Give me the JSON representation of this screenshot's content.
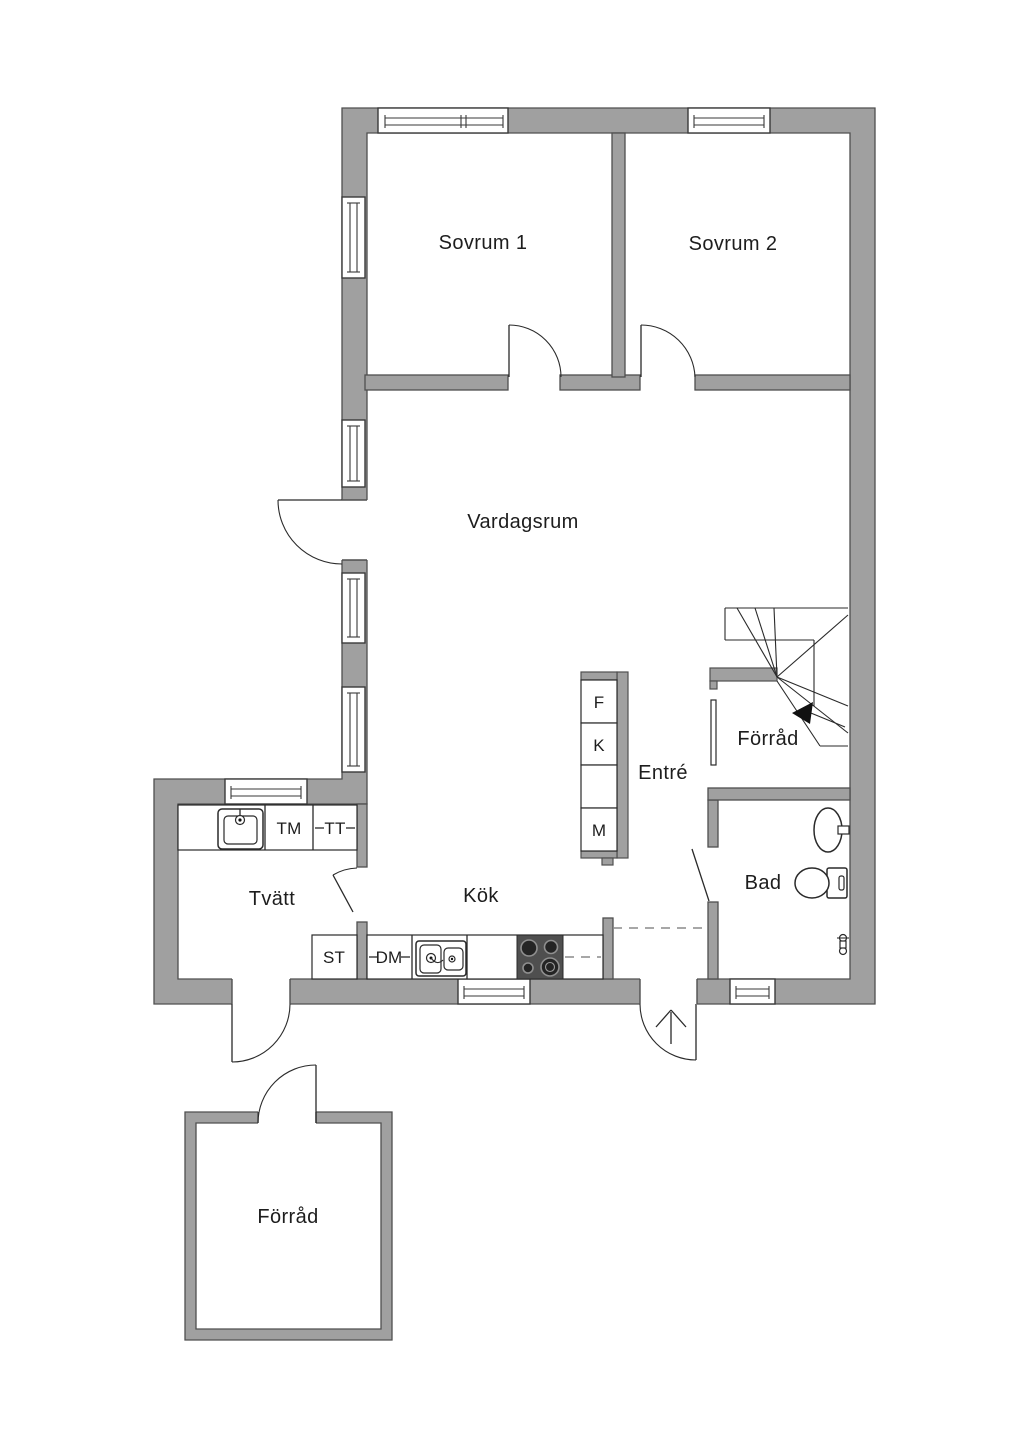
{
  "title": "Floor plan",
  "labels": {
    "sovrum1": "Sovrum 1",
    "sovrum2": "Sovrum 2",
    "vardagsrum": "Vardagsrum",
    "entre": "Entré",
    "forrad_stairs": "Förråd",
    "bad": "Bad",
    "tvatt": "Tvätt",
    "kok": "Kök",
    "forrad_outbuilding": "Förråd"
  },
  "appliances": {
    "tm": "TM",
    "tt": "TT",
    "st": "ST",
    "dm": "DM",
    "f": "F",
    "k": "K",
    "m": "M"
  },
  "colors": {
    "background": "#ffffff",
    "wall": "#a0a0a0",
    "wall_outline": "#4f4f4f",
    "line": "#2a2a2a",
    "text": "#1d1d1d",
    "stove_panel": "#4f4f4f"
  },
  "icons": [
    "window-icon",
    "door-swing-icon",
    "staircase-icon",
    "entrance-arrow-icon",
    "laundry-sink-icon",
    "kitchen-sink-icon",
    "stove-icon",
    "bath-sink-icon",
    "toilet-icon",
    "shower-mixer-icon"
  ]
}
